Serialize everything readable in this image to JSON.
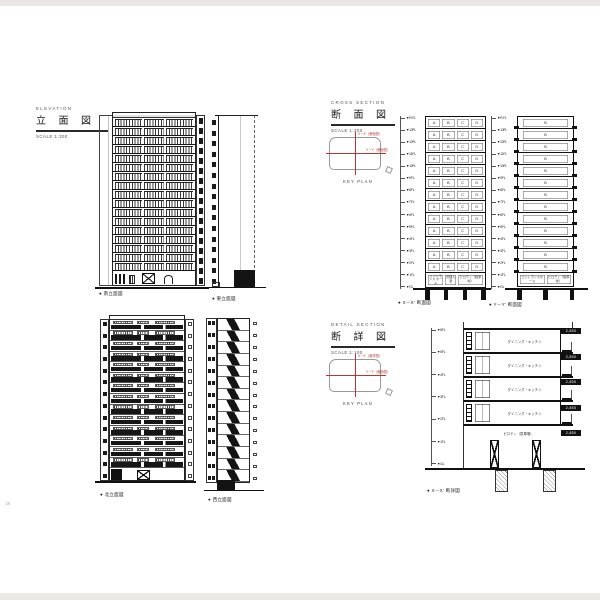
{
  "colors": {
    "accent_red": "#b03a2e"
  },
  "page": {
    "number": "18"
  },
  "elevation_section": {
    "title_en": "ELEVATION",
    "title_ja": "立 面 図",
    "scale": "SCALE 1:300",
    "south": {
      "caption": "● 南立面図",
      "floors": 17
    },
    "east": {
      "caption": "● 東立面図",
      "floors": 16
    },
    "north": {
      "caption": "● 北立面図",
      "floors": 14
    },
    "west": {
      "caption": "● 西立面図",
      "floors": 14
    }
  },
  "cross_section": {
    "title_en": "CROSS SECTION",
    "title_ja": "断 面 図",
    "scale": "SCALE 1:300",
    "key_plan": {
      "label": "KEY PLAN",
      "x_line": "X－X'（断面図）",
      "y_line": "Y－Y'（断面図）"
    },
    "levels": [
      "▼R.FL",
      "▼13FL",
      "▼12FL",
      "▼11FL",
      "▼10FL",
      "▼9FL",
      "▼8FL",
      "▼7FL",
      "▼6FL",
      "▼5FL",
      "▼4FL",
      "▼3FL",
      "▼2FL",
      "▼1FL",
      "▼GL"
    ],
    "section_x": {
      "caption": "● X－X′ 断面図",
      "floors": 13,
      "unit_labels": [
        "A",
        "B",
        "C",
        "D"
      ],
      "ground_rooms": [
        "エントランス ホール",
        "管理人 室",
        "ピロティ（駐車場）"
      ]
    },
    "section_y": {
      "caption": "● Y－Y′ 断面図",
      "floors": 13,
      "unit_label": "B",
      "ground_rooms": [
        "エントランスホール",
        "ピロティ（駐車場）"
      ]
    }
  },
  "detail_section": {
    "title_en": "DETAIL SECTION",
    "title_ja": "断 詳 図",
    "scale": "SCALE 1:100",
    "key_plan": {
      "label": "KEY PLAN",
      "x_line": "X－X'（断詳図）",
      "y_line": "Y－Y'（断面図）"
    },
    "drawing": {
      "caption": "● X－X′ 断詳図",
      "floors": 4,
      "room_label": "ダイニング・キッチン",
      "ground_label": "ピロティ（駐車場）",
      "levels": [
        "▼6FL",
        "▼5FL",
        "▼4FL",
        "▼3FL",
        "▼2FL",
        "▼1FL",
        "▼GL"
      ],
      "floor_heights": [
        "2,850",
        "2,850",
        "2,850",
        "2,850",
        "2,850"
      ]
    }
  }
}
